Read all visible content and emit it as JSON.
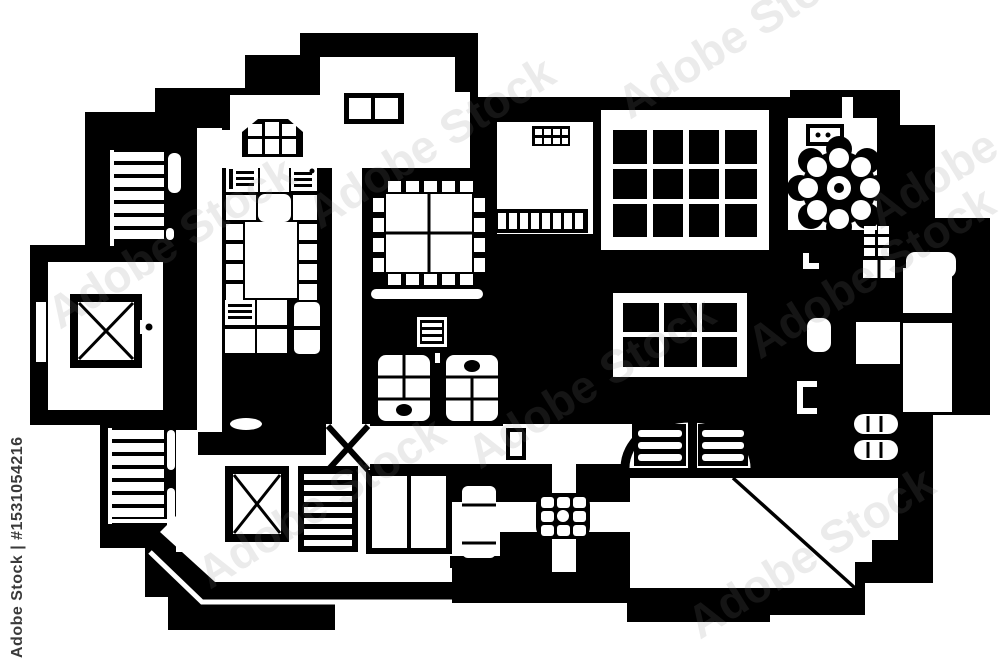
{
  "image": {
    "title": "Hand-drawn black and white architectural floor plan, top view",
    "colors": {
      "ink": "#000000",
      "paper": "#ffffff",
      "watermark_diagonal": "rgba(128,128,128,0.16)",
      "watermark_side": "#3a3a3a"
    }
  },
  "watermark": {
    "diagonal_text": "Adobe Stock",
    "side_text": "Adobe Stock | #1531054216"
  },
  "floor_plan": {
    "rooms": [
      "entry-hall",
      "kitchen",
      "dining-room",
      "study-room",
      "breakfast-nook",
      "left-wing-lift-room",
      "bedroom",
      "bathrooms",
      "sunroom-corridor",
      "terrace-room",
      "right-balcony-rooms"
    ],
    "icons": [
      "staircase-icon",
      "elevator-shaft-icon",
      "bay-window-icon",
      "double-window-icon",
      "roof-window-grid-icon",
      "dining-table-icon",
      "round-table-with-chairs-icon",
      "cooktop-icon",
      "wall-shelf-icon",
      "radiator-icon",
      "skylight-cross-icon",
      "wardrobe-shelves-icon",
      "double-bed-icon",
      "vanity-sink-icon",
      "oven-icon",
      "door-leaf-icon",
      "door-swing-icon",
      "arched-bed-icon",
      "sun-table-icon",
      "cabinet-grid-icon",
      "terrace-diagonal-icon"
    ]
  }
}
